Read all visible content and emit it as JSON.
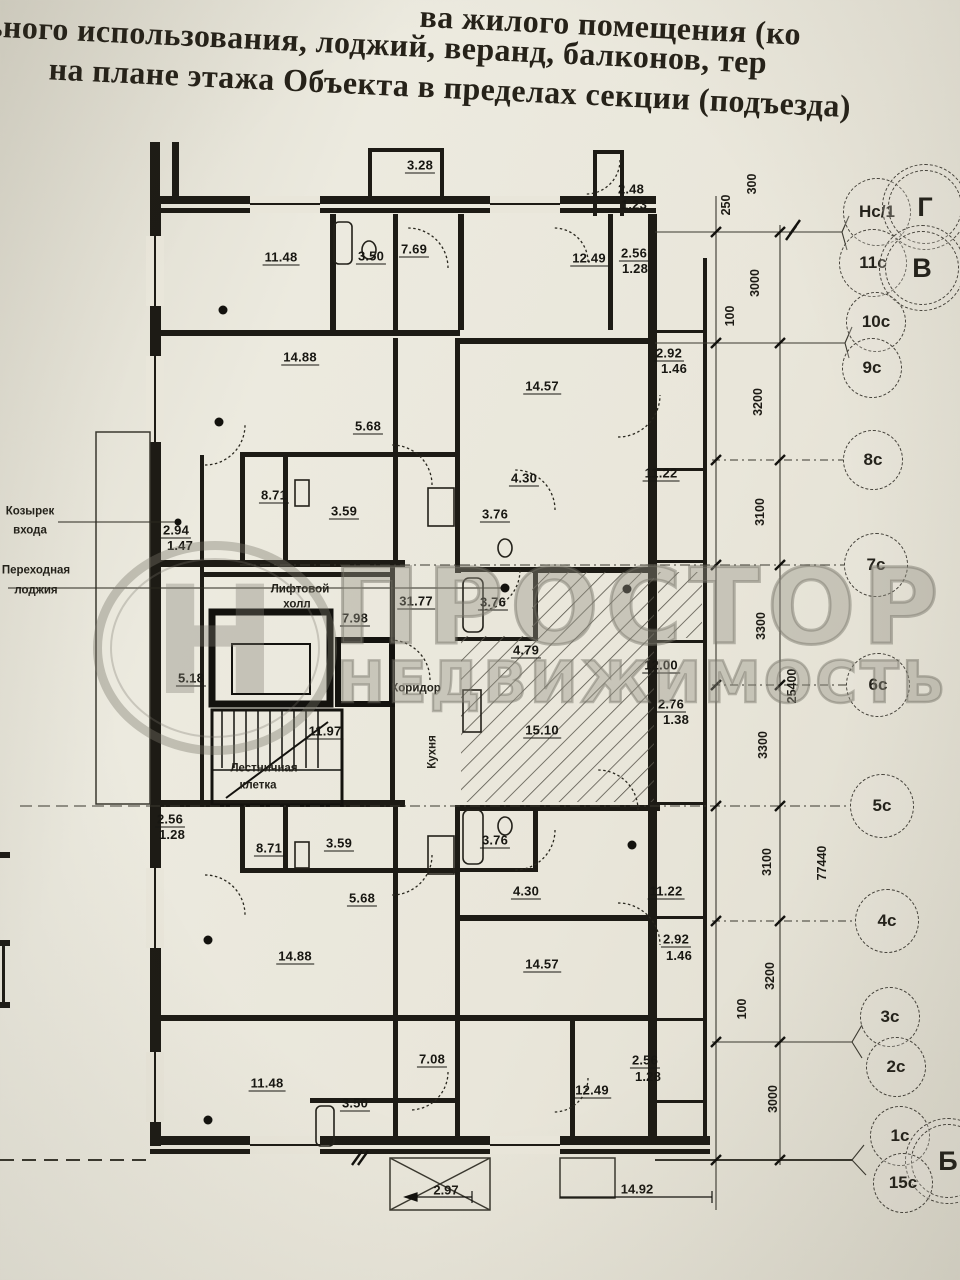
{
  "header": {
    "line1": "ва жилого помещения (ко",
    "line2": "тельного использования, лоджий, веранд, балконов, тер",
    "line3": "на плане этажа Объекта в пределах секции (подъезда)"
  },
  "watermark": {
    "logo_glyph": "Н",
    "brand_line1": "ПРОСТОР",
    "brand_line2": "НЕДВИЖИМОСТЬ"
  },
  "colors": {
    "paper": "#e9e6da",
    "ink": "#201e18",
    "watermark_gray": "#8a887b"
  },
  "side_labels": [
    {
      "text": "Козырек",
      "x": 30,
      "y": 512
    },
    {
      "text": "входа",
      "x": 30,
      "y": 531
    },
    {
      "text": "Переходная",
      "x": 36,
      "y": 571
    },
    {
      "text": "лоджия",
      "x": 36,
      "y": 591
    }
  ],
  "plan_text_labels": [
    {
      "text": "Лифтовой",
      "x": 300,
      "y": 590
    },
    {
      "text": "холл",
      "x": 297,
      "y": 605
    },
    {
      "text": "Лестничная",
      "x": 264,
      "y": 769
    },
    {
      "text": "клетка",
      "x": 258,
      "y": 786
    },
    {
      "text": "Коридор",
      "x": 416,
      "y": 689
    },
    {
      "text": "Кухня",
      "x": 433,
      "y": 752,
      "rot": true
    }
  ],
  "room_areas": [
    {
      "v": "3.28",
      "x": 420,
      "y": 166
    },
    {
      "v": "2.48",
      "x": 631,
      "y": 190
    },
    {
      "v": "1.23",
      "x": 634,
      "y": 205,
      "u": false
    },
    {
      "v": "11.48",
      "x": 281,
      "y": 258
    },
    {
      "v": "3.50",
      "x": 371,
      "y": 257
    },
    {
      "v": "7.69",
      "x": 414,
      "y": 250
    },
    {
      "v": "12.49",
      "x": 589,
      "y": 259
    },
    {
      "v": "2.56",
      "x": 634,
      "y": 254
    },
    {
      "v": "1.28",
      "x": 635,
      "y": 269,
      "u": false
    },
    {
      "v": "14.88",
      "x": 300,
      "y": 358
    },
    {
      "v": "2.92",
      "x": 669,
      "y": 354
    },
    {
      "v": "1.46",
      "x": 674,
      "y": 369,
      "u": false
    },
    {
      "v": "14.57",
      "x": 542,
      "y": 387
    },
    {
      "v": "5.68",
      "x": 368,
      "y": 427
    },
    {
      "v": "4.30",
      "x": 524,
      "y": 479
    },
    {
      "v": "11.22",
      "x": 661,
      "y": 474
    },
    {
      "v": "8.71",
      "x": 274,
      "y": 496
    },
    {
      "v": "3.59",
      "x": 344,
      "y": 512
    },
    {
      "v": "3.76",
      "x": 495,
      "y": 515
    },
    {
      "v": "2.94",
      "x": 176,
      "y": 531
    },
    {
      "v": "1.47",
      "x": 180,
      "y": 546,
      "u": false
    },
    {
      "v": "31.77",
      "x": 416,
      "y": 602
    },
    {
      "v": "3.76",
      "x": 493,
      "y": 603
    },
    {
      "v": "7.98",
      "x": 355,
      "y": 619
    },
    {
      "v": "5.18",
      "x": 191,
      "y": 679
    },
    {
      "v": "4.79",
      "x": 526,
      "y": 651
    },
    {
      "v": "12.00",
      "x": 661,
      "y": 666
    },
    {
      "v": "2.76",
      "x": 671,
      "y": 705
    },
    {
      "v": "1.38",
      "x": 676,
      "y": 720,
      "u": false
    },
    {
      "v": "15.10",
      "x": 542,
      "y": 731
    },
    {
      "v": "11.97",
      "x": 325,
      "y": 732
    },
    {
      "v": "2.56",
      "x": 170,
      "y": 820
    },
    {
      "v": "1.28",
      "x": 172,
      "y": 835,
      "u": false
    },
    {
      "v": "8.71",
      "x": 269,
      "y": 849
    },
    {
      "v": "3.59",
      "x": 339,
      "y": 844
    },
    {
      "v": "3.76",
      "x": 495,
      "y": 841
    },
    {
      "v": "5.68",
      "x": 362,
      "y": 899
    },
    {
      "v": "4.30",
      "x": 526,
      "y": 892
    },
    {
      "v": "11.22",
      "x": 666,
      "y": 892
    },
    {
      "v": "14.88",
      "x": 295,
      "y": 957
    },
    {
      "v": "14.57",
      "x": 542,
      "y": 965
    },
    {
      "v": "2.92",
      "x": 676,
      "y": 940
    },
    {
      "v": "1.46",
      "x": 679,
      "y": 956,
      "u": false
    },
    {
      "v": "7.08",
      "x": 432,
      "y": 1060
    },
    {
      "v": "11.48",
      "x": 267,
      "y": 1084
    },
    {
      "v": "3.50",
      "x": 355,
      "y": 1104
    },
    {
      "v": "12.49",
      "x": 592,
      "y": 1091
    },
    {
      "v": "2.56",
      "x": 645,
      "y": 1061
    },
    {
      "v": "1.28",
      "x": 648,
      "y": 1077,
      "u": false
    }
  ],
  "dims_vertical": [
    {
      "v": "250",
      "x": 726,
      "y": 205
    },
    {
      "v": "300",
      "x": 752,
      "y": 184
    },
    {
      "v": "3000",
      "x": 755,
      "y": 283
    },
    {
      "v": "100",
      "x": 730,
      "y": 316
    },
    {
      "v": "3200",
      "x": 758,
      "y": 402
    },
    {
      "v": "3100",
      "x": 760,
      "y": 512
    },
    {
      "v": "3300",
      "x": 761,
      "y": 626
    },
    {
      "v": "25400",
      "x": 792,
      "y": 686
    },
    {
      "v": "3300",
      "x": 763,
      "y": 745
    },
    {
      "v": "3100",
      "x": 767,
      "y": 862
    },
    {
      "v": "77440",
      "x": 822,
      "y": 863
    },
    {
      "v": "3200",
      "x": 770,
      "y": 976
    },
    {
      "v": "100",
      "x": 742,
      "y": 1009
    },
    {
      "v": "3000",
      "x": 773,
      "y": 1099
    }
  ],
  "dims_horizontal": [
    {
      "v": "14.92",
      "x": 637,
      "y": 1189
    },
    {
      "v": "2.97",
      "x": 446,
      "y": 1190
    }
  ],
  "axes": [
    {
      "label": "Нс/1",
      "x": 877,
      "y": 212,
      "r": 33
    },
    {
      "label": "Г",
      "x": 925,
      "y": 207,
      "r": 42,
      "big": true
    },
    {
      "label": "11с",
      "x": 873,
      "y": 263,
      "r": 33
    },
    {
      "label": "В",
      "x": 922,
      "y": 268,
      "r": 42,
      "big": true
    },
    {
      "label": "10с",
      "x": 876,
      "y": 322,
      "r": 29
    },
    {
      "label": "9с",
      "x": 872,
      "y": 368,
      "r": 29
    },
    {
      "label": "8с",
      "x": 873,
      "y": 460,
      "r": 29
    },
    {
      "label": "7с",
      "x": 876,
      "y": 565,
      "r": 31
    },
    {
      "label": "6с",
      "x": 878,
      "y": 685,
      "r": 31
    },
    {
      "label": "5с",
      "x": 882,
      "y": 806,
      "r": 31
    },
    {
      "label": "4с",
      "x": 887,
      "y": 921,
      "r": 31
    },
    {
      "label": "3с",
      "x": 890,
      "y": 1017,
      "r": 29
    },
    {
      "label": "2с",
      "x": 896,
      "y": 1067,
      "r": 29
    },
    {
      "label": "1с",
      "x": 900,
      "y": 1136,
      "r": 29
    },
    {
      "label": "Б",
      "x": 948,
      "y": 1161,
      "r": 42,
      "big": true
    },
    {
      "label": "15с",
      "x": 903,
      "y": 1183,
      "r": 29
    }
  ]
}
